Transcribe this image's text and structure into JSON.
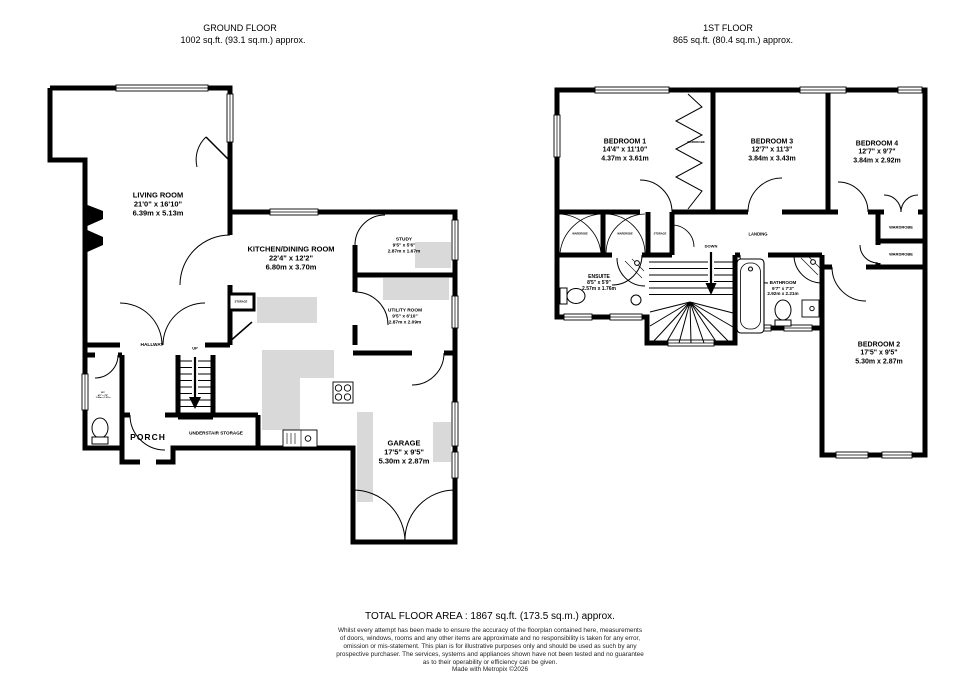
{
  "colors": {
    "wall": "#000000",
    "shading": "#d9d9d9",
    "background": "#ffffff"
  },
  "ground_floor": {
    "title": "GROUND FLOOR",
    "area": "1002 sq.ft. (93.1 sq.m.) approx.",
    "rooms": {
      "living": {
        "name": "LIVING ROOM",
        "imperial": "21'0\" x 16'10\"",
        "metric": "6.39m x 5.13m"
      },
      "kitchen": {
        "name": "KITCHEN/DINING ROOM",
        "imperial": "22'4\" x 12'2\"",
        "metric": "6.80m x 3.70m"
      },
      "study": {
        "name": "STUDY",
        "imperial": "9'5\" x 5'6\"",
        "metric": "2.87m x 1.67m"
      },
      "utility": {
        "name": "UTILITY ROOM",
        "imperial": "9'5\" x 6'10\"",
        "metric": "2.87m x 2.09m"
      },
      "garage": {
        "name": "GARAGE",
        "imperial": "17'5\" x 9'5\"",
        "metric": "5.30m x 2.87m"
      },
      "hallway": {
        "name": "HALLWAY"
      },
      "porch": {
        "name": "PORCH"
      },
      "understair": {
        "name": "UNDERSTAIR STORAGE"
      },
      "storage": {
        "name": "STORAGE"
      },
      "up": {
        "name": "UP"
      },
      "wc": {
        "name": "WC",
        "imperial": "4'6\" x 3'6\"",
        "metric": "1.38m x 1.07m"
      }
    }
  },
  "first_floor": {
    "title": "1ST FLOOR",
    "area": "865 sq.ft. (80.4 sq.m.) approx.",
    "rooms": {
      "bedroom1": {
        "name": "BEDROOM 1",
        "imperial": "14'4\" x 11'10\"",
        "metric": "4.37m x 3.61m"
      },
      "bedroom2": {
        "name": "BEDROOM 2",
        "imperial": "17'5\" x 9'5\"",
        "metric": "5.30m x 2.87m"
      },
      "bedroom3": {
        "name": "BEDROOM 3",
        "imperial": "12'7\" x 11'3\"",
        "metric": "3.84m x 3.43m"
      },
      "bedroom4": {
        "name": "BEDROOM 4",
        "imperial": "12'7\" x 9'7\"",
        "metric": "3.84m x 2.92m"
      },
      "ensuite": {
        "name": "ENSUITE",
        "imperial": "8'5\" x 5'9\"",
        "metric": "2.57m x 1.76m"
      },
      "bathroom": {
        "name": "BATHROOM",
        "imperial": "9'7\" x 7'3\"",
        "metric": "2.92m x 2.21m"
      },
      "landing": {
        "name": "LANDING"
      },
      "down": {
        "name": "DOWN"
      },
      "wardrobe": {
        "name": "WARDROBE"
      },
      "storage": {
        "name": "STORAGE"
      }
    }
  },
  "footer": {
    "total": "TOTAL FLOOR AREA : 1867 sq.ft. (173.5 sq.m.) approx.",
    "disclaimer": [
      "Whilst every attempt has been made to ensure the accuracy of the floorplan contained here, measurements",
      "of doors, windows, rooms and any other items are approximate and no responsibility is taken for any error,",
      "omission or mis-statement. This plan is for illustrative purposes only and should be used as such by any",
      "prospective purchaser. The services, systems and appliances shown have not been tested and no guarantee",
      "as to their operability or efficiency can be given."
    ],
    "credit": "Made with Metropix ©2026"
  }
}
